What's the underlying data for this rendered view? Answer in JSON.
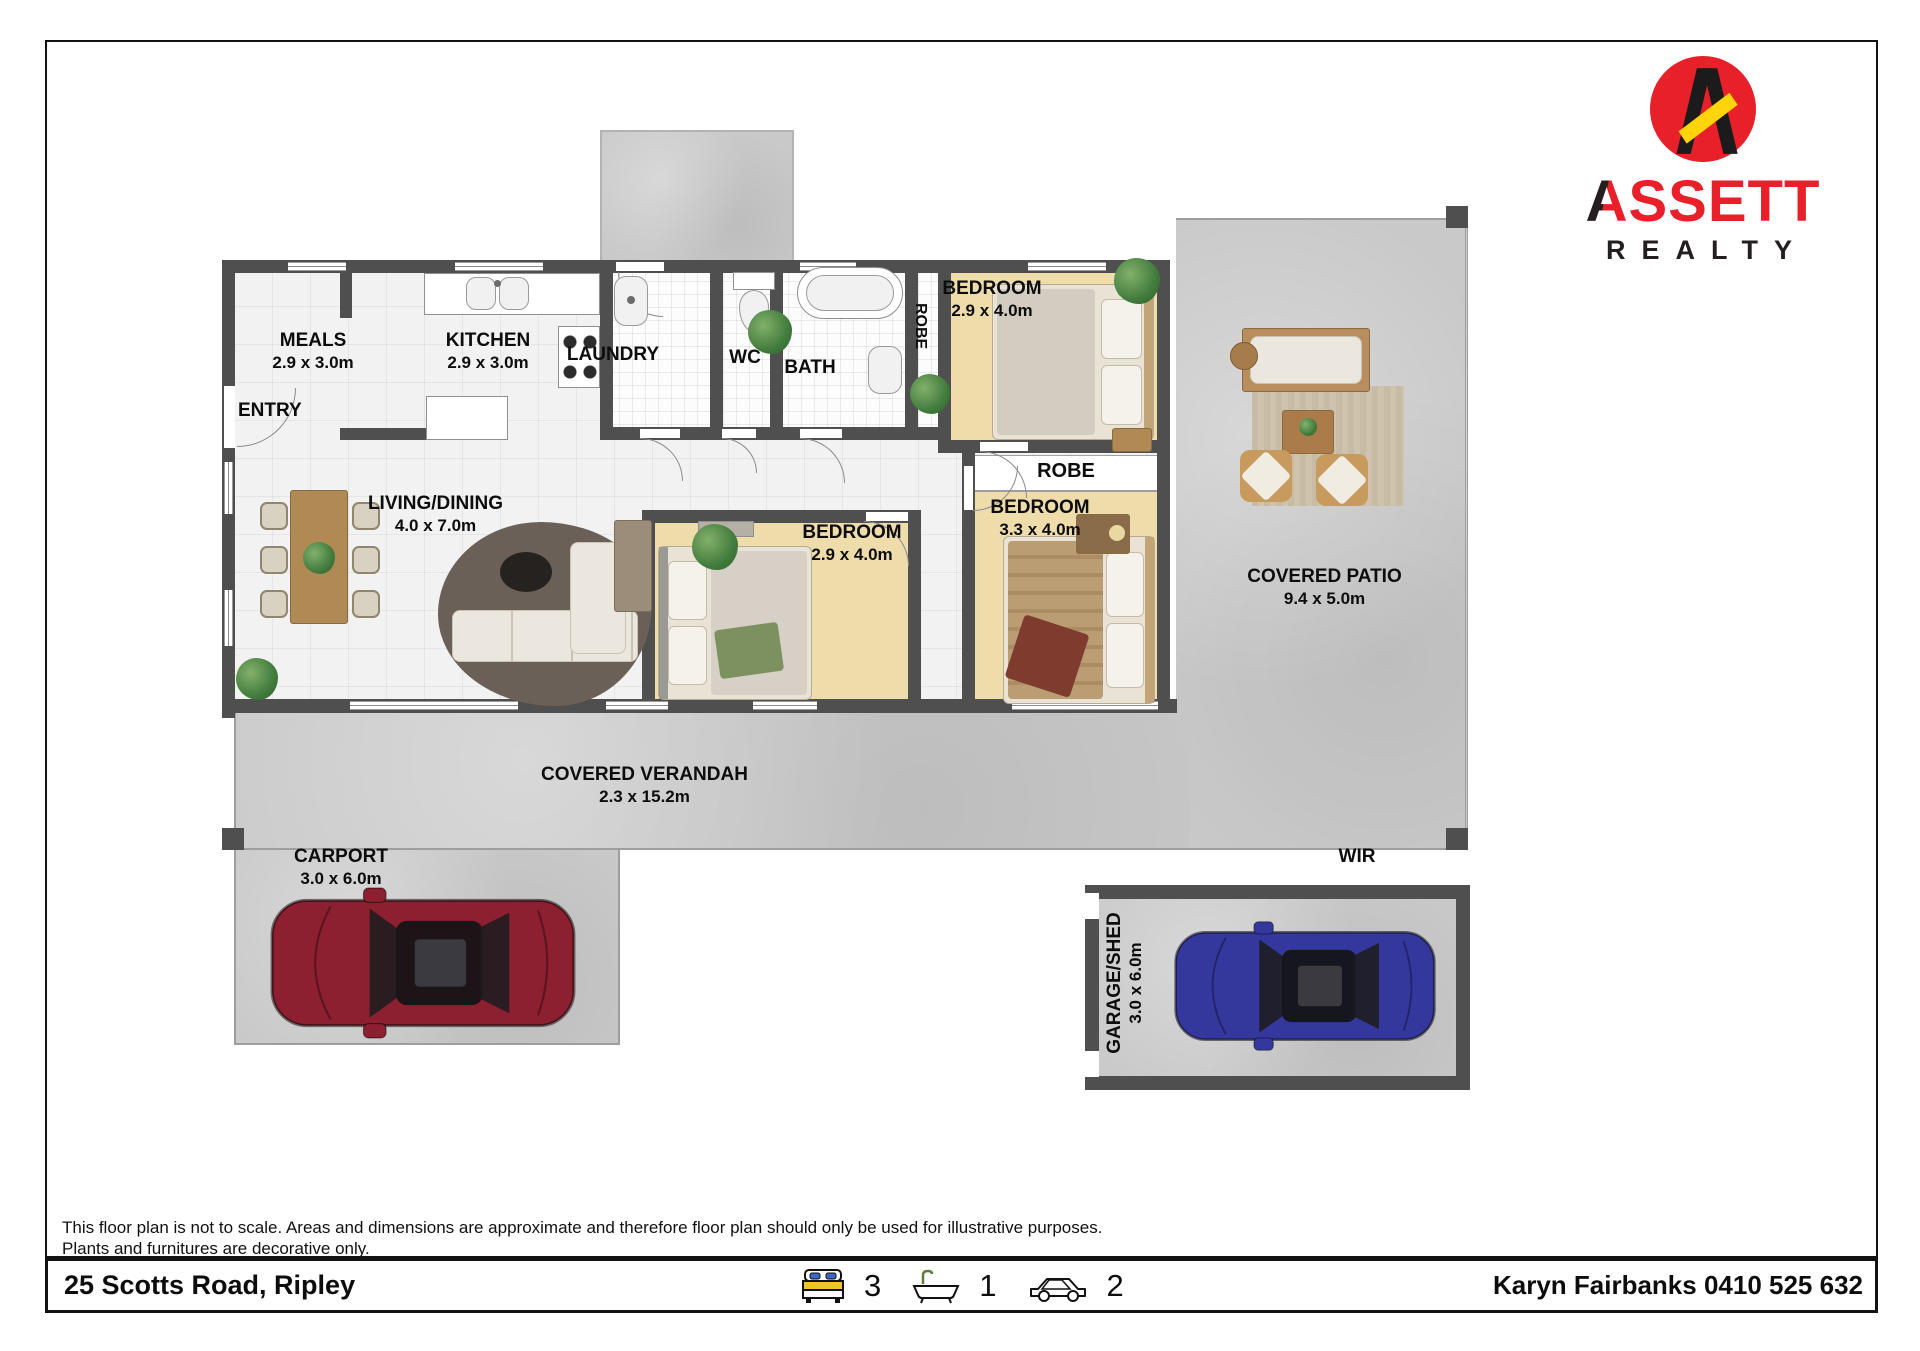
{
  "page": {
    "disclaimer_line1": "This floor plan is not to scale. Areas and dimensions are approximate and therefore floor plan should only be used for illustrative purposes.",
    "disclaimer_line2": "Plants and furnitures are decorative only.",
    "address": "25 Scotts Road, Ripley",
    "agent": "Karyn Fairbanks 0410 525 632",
    "beds": "3",
    "baths": "1",
    "cars": "2"
  },
  "logo": {
    "initial": "A",
    "rest": "SSETT",
    "tagline": "REALTY"
  },
  "rooms": {
    "meals": {
      "name": "MEALS",
      "dims": "2.9 x 3.0m"
    },
    "kitchen": {
      "name": "KITCHEN",
      "dims": "2.9 x 3.0m"
    },
    "laundry": {
      "name": "LAUNDRY"
    },
    "wc": {
      "name": "WC"
    },
    "bath": {
      "name": "BATH"
    },
    "robe1": {
      "name": "ROBE"
    },
    "robe2": {
      "name": "ROBE"
    },
    "entry": {
      "name": "ENTRY"
    },
    "living": {
      "name": "LIVING/DINING",
      "dims": "4.0 x 7.0m"
    },
    "bedroom1": {
      "name": "BEDROOM",
      "dims": "2.9 x 4.0m"
    },
    "bedroom2": {
      "name": "BEDROOM",
      "dims": "2.9 x 4.0m"
    },
    "bedroom3": {
      "name": "BEDROOM",
      "dims": "3.3 x 4.0m"
    },
    "patio": {
      "name": "COVERED PATIO",
      "dims": "9.4 x 5.0m"
    },
    "verandah": {
      "name": "COVERED VERANDAH",
      "dims": "2.3 x 15.2m"
    },
    "carport": {
      "name": "CARPORT",
      "dims": "3.0 x 6.0m"
    },
    "garage": {
      "name": "GARAGE/SHED",
      "dims": "3.0 x 6.0m"
    },
    "wir": {
      "name": "WIR"
    }
  },
  "colors": {
    "wall": "#4f4f4f",
    "bedroom_floor": "#eedcab",
    "concrete": "#c9c9c9",
    "logo_red": "#e8202a",
    "logo_yellow": "#ffd40a",
    "car_red": "#8c1f30",
    "car_blue": "#34379b"
  }
}
